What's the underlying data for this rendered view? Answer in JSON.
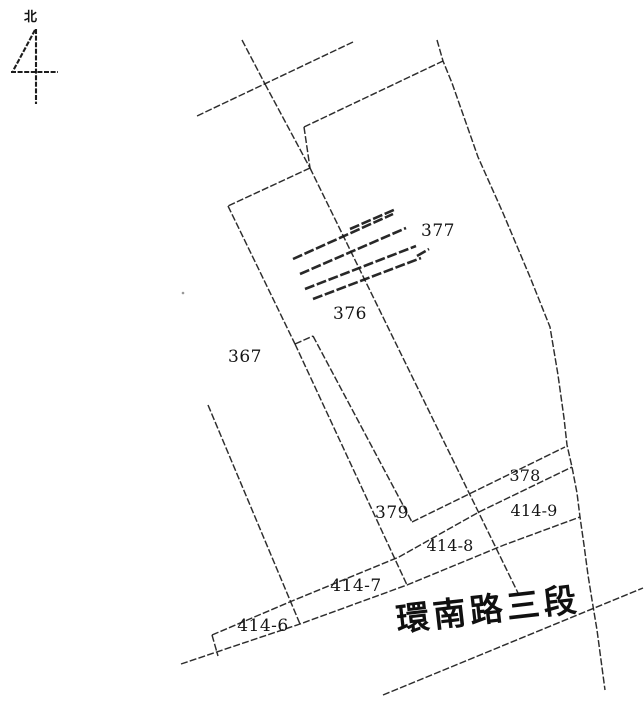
{
  "compass": {
    "label": "北"
  },
  "parcels": [
    {
      "id": "377"
    },
    {
      "id": "376"
    },
    {
      "id": "367"
    },
    {
      "id": "379"
    },
    {
      "id": "378"
    },
    {
      "id": "414-9"
    },
    {
      "id": "414-8"
    },
    {
      "id": "414-7"
    },
    {
      "id": "414-6"
    }
  ],
  "road": {
    "name": "環南路三段"
  },
  "hatch": {
    "marked_boundary": "376/377"
  },
  "colors": {
    "ink": "#1b1b1b",
    "paper": "#ffffff"
  }
}
